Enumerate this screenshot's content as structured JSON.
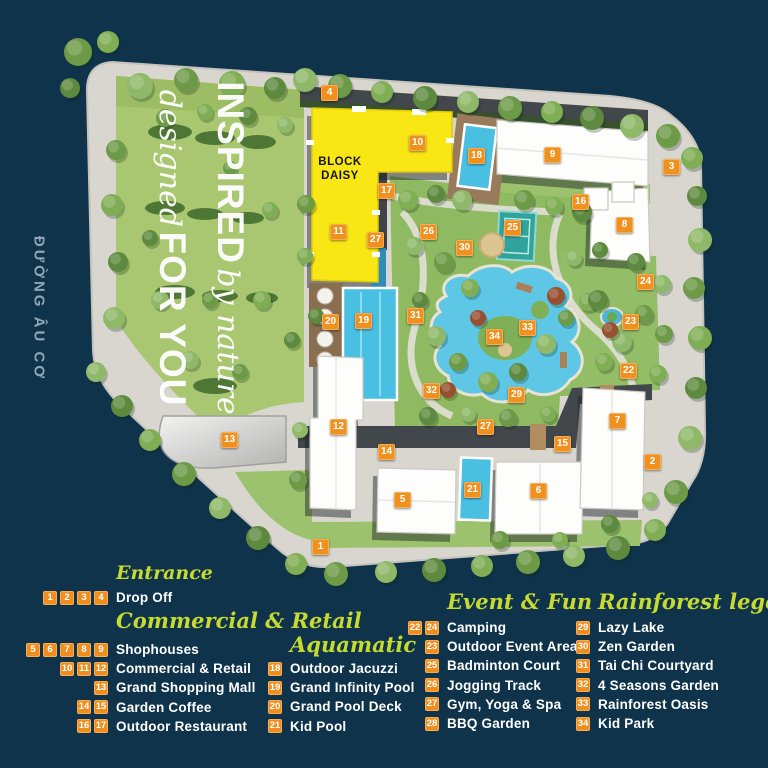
{
  "street_label": "ĐƯỜNG ÂU CƠ",
  "slogan": {
    "line1_strong": "INSPIRED",
    "line1_script": "by nature",
    "line2_script": "designed",
    "line2_strong": "FOR YOU"
  },
  "block_label": {
    "line1": "BLOCK",
    "line2": "DAISY"
  },
  "colors": {
    "background_navy": "#0e334b",
    "marker_orange": "#f0901e",
    "legend_header_green": "#c6da2f",
    "block_yellow": "#f9e715",
    "pool_cyan": "#49bfe2",
    "legend_text": "#ffffff"
  },
  "map_markers": [
    {
      "n": "1",
      "x": 321,
      "y": 547
    },
    {
      "n": "2",
      "x": 653,
      "y": 462
    },
    {
      "n": "3",
      "x": 672,
      "y": 167
    },
    {
      "n": "4",
      "x": 330,
      "y": 93
    },
    {
      "n": "5",
      "x": 403,
      "y": 500
    },
    {
      "n": "6",
      "x": 539,
      "y": 491
    },
    {
      "n": "7",
      "x": 618,
      "y": 421
    },
    {
      "n": "8",
      "x": 625,
      "y": 225
    },
    {
      "n": "9",
      "x": 553,
      "y": 155
    },
    {
      "n": "10",
      "x": 418,
      "y": 143
    },
    {
      "n": "11",
      "x": 339,
      "y": 232
    },
    {
      "n": "12",
      "x": 339,
      "y": 427
    },
    {
      "n": "13",
      "x": 230,
      "y": 440
    },
    {
      "n": "14",
      "x": 387,
      "y": 452
    },
    {
      "n": "15",
      "x": 563,
      "y": 444
    },
    {
      "n": "16",
      "x": 581,
      "y": 202
    },
    {
      "n": "17",
      "x": 387,
      "y": 191
    },
    {
      "n": "18",
      "x": 477,
      "y": 156
    },
    {
      "n": "19",
      "x": 364,
      "y": 321
    },
    {
      "n": "20",
      "x": 331,
      "y": 322
    },
    {
      "n": "21",
      "x": 473,
      "y": 490
    },
    {
      "n": "22",
      "x": 629,
      "y": 371
    },
    {
      "n": "23",
      "x": 631,
      "y": 322
    },
    {
      "n": "24",
      "x": 646,
      "y": 282
    },
    {
      "n": "25",
      "x": 513,
      "y": 228
    },
    {
      "n": "26",
      "x": 429,
      "y": 232
    },
    {
      "n": "27",
      "x": 376,
      "y": 240
    },
    {
      "n": "27",
      "x": 486,
      "y": 427
    },
    {
      "n": "29",
      "x": 517,
      "y": 395
    },
    {
      "n": "30",
      "x": 465,
      "y": 248
    },
    {
      "n": "31",
      "x": 416,
      "y": 316
    },
    {
      "n": "32",
      "x": 432,
      "y": 391
    },
    {
      "n": "33",
      "x": 528,
      "y": 328
    },
    {
      "n": "34",
      "x": 495,
      "y": 337
    }
  ],
  "legend": {
    "groups": [
      {
        "title": "Entrance",
        "rows": [
          {
            "nums": [
              "1",
              "2",
              "3",
              "4"
            ],
            "label": "Drop Off"
          }
        ]
      },
      {
        "title": "Commercial & Retail",
        "rows": [
          {
            "nums": [
              "5",
              "6",
              "7",
              "8",
              "9"
            ],
            "label": "Shophouses"
          },
          {
            "nums": [
              "10",
              "11",
              "12"
            ],
            "label": "Commercial & Retail"
          },
          {
            "nums": [
              "13"
            ],
            "label": "Grand Shopping Mall"
          },
          {
            "nums": [
              "14",
              "15"
            ],
            "label": "Garden Coffee"
          },
          {
            "nums": [
              "16",
              "17"
            ],
            "label": "Outdoor Restaurant"
          }
        ]
      },
      {
        "title": "Aquamatic",
        "rows": [
          {
            "nums": [
              "18"
            ],
            "label": "Outdoor Jacuzzi"
          },
          {
            "nums": [
              "19"
            ],
            "label": "Grand Infinity Pool"
          },
          {
            "nums": [
              "20"
            ],
            "label": "Grand Pool Deck"
          },
          {
            "nums": [
              "21"
            ],
            "label": "Kid Pool"
          }
        ]
      },
      {
        "title": "Event & Fun",
        "rows": [
          {
            "nums": [
              "22",
              "24"
            ],
            "label": "Camping"
          },
          {
            "nums": [
              "23"
            ],
            "label": "Outdoor Event Area"
          },
          {
            "nums": [
              "25"
            ],
            "label": "Badminton Court"
          },
          {
            "nums": [
              "26"
            ],
            "label": "Jogging Track"
          },
          {
            "nums": [
              "27"
            ],
            "label": "Gym, Yoga & Spa"
          },
          {
            "nums": [
              "28"
            ],
            "label": "BBQ Garden"
          }
        ]
      },
      {
        "title": "Rainforest legend",
        "rows": [
          {
            "nums": [
              "29"
            ],
            "label": "Lazy Lake"
          },
          {
            "nums": [
              "30"
            ],
            "label": "Zen Garden"
          },
          {
            "nums": [
              "31"
            ],
            "label": "Tai Chi Courtyard"
          },
          {
            "nums": [
              "32"
            ],
            "label": "4 Seasons Garden"
          },
          {
            "nums": [
              "33"
            ],
            "label": "Rainforest Oasis"
          },
          {
            "nums": [
              "34"
            ],
            "label": "Kid Park"
          }
        ]
      }
    ]
  }
}
